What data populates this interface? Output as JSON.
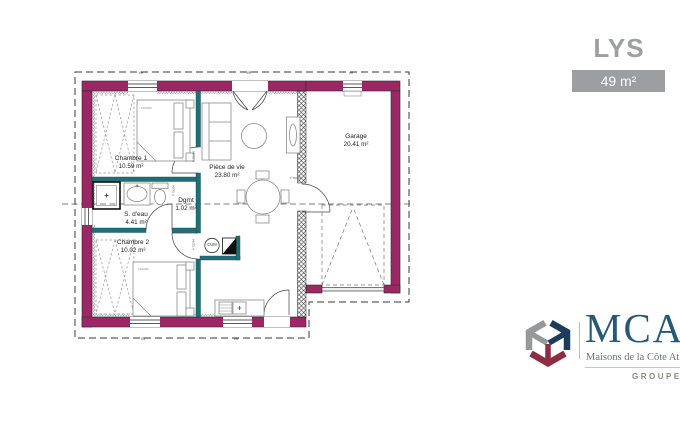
{
  "header": {
    "model_name": "LYS",
    "area_badge": "49 m²"
  },
  "plan": {
    "rooms": [
      {
        "id": "chambre-1",
        "name": "Chambre 1",
        "area": "10.59 m²"
      },
      {
        "id": "s-deau",
        "name": "S. d'eau",
        "area": "4.41 m²"
      },
      {
        "id": "chambre-2",
        "name": "Chambre 2",
        "area": "10.02 m²"
      },
      {
        "id": "degagement",
        "name": "Dgmt",
        "area": "1.02 m²"
      },
      {
        "id": "piece-de-vie",
        "name": "Pièce de vie",
        "area": "23.80 m²"
      },
      {
        "id": "garage",
        "name": "Garage",
        "area": "20.41 m²"
      }
    ],
    "labels": {
      "water_heater": "CUM",
      "bed_dimensions": "140x200",
      "door_spec": "P 75/204",
      "window_shutter": "VR"
    },
    "colors": {
      "exterior_wall": "#9d2765",
      "partition_wall": "#206f78"
    }
  },
  "logo": {
    "acronym": "MCA",
    "tagline": "Maisons de la Côte Atlantique",
    "group": "GROUPE HEXAOM",
    "colors": {
      "navy": "#1d3c58",
      "maroon": "#8e2c42",
      "gray": "#96989a",
      "wordmark": "#275877"
    }
  }
}
